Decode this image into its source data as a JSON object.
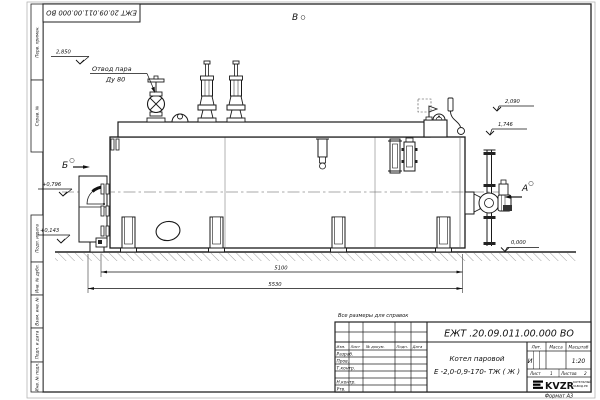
{
  "sheet": {
    "top_stamp": "ЕЖТ 20.09.011.00.000  ВО",
    "note": "Все размеры для справок",
    "format_label": "Формат  А3",
    "side_labels": [
      "Перв. примен.",
      "Справ. №",
      "Подп. и дата",
      "Инв. № дубл.",
      "Взам. инв. №",
      "Подп. и дата",
      "Инв. № подл."
    ]
  },
  "views": {
    "top_view": "В",
    "section_left": "Б",
    "section_right": "А"
  },
  "callout": {
    "line1": "Отвод пара",
    "line2": "Ду 80"
  },
  "elevations": {
    "e2850": "2,850",
    "e2090": "2,090",
    "e1746": "1,746",
    "e0796": "+0,796",
    "e0143": "+0,143",
    "e0000": "0,000"
  },
  "dimensions": {
    "shell_length": "5100",
    "overall_length": "5530"
  },
  "title_block": {
    "doc_number": "ЕЖТ .20.09.011.00.000  ВО",
    "product_line1": "Котел паровой",
    "product_line2": "Е -2,0-0,9-170- ТЖ ( Ж )",
    "cols": {
      "izm": "Изм.",
      "list": "Лист",
      "doc": "№ докум.",
      "podp": "Подп.",
      "data": "Дата"
    },
    "rows": {
      "razrab": "Разраб.",
      "prov": "Пров.",
      "tkontr": "Т.контр.",
      "nkontr": "Н.контр.",
      "utv": "Утв."
    },
    "lit_label": "Лит.",
    "mass_label": "Масса",
    "scale_label": "Масштаб",
    "lit_value": "И",
    "scale_value": "1:20",
    "sheet_label": "Лист",
    "sheet_value": "1",
    "sheets_label": "Листов",
    "sheets_value": "2",
    "logo_text": "KVZR",
    "logo_sub1": "КОТЕЛЬНЫЙ",
    "logo_sub2": "ЗАВОД.РФ"
  }
}
